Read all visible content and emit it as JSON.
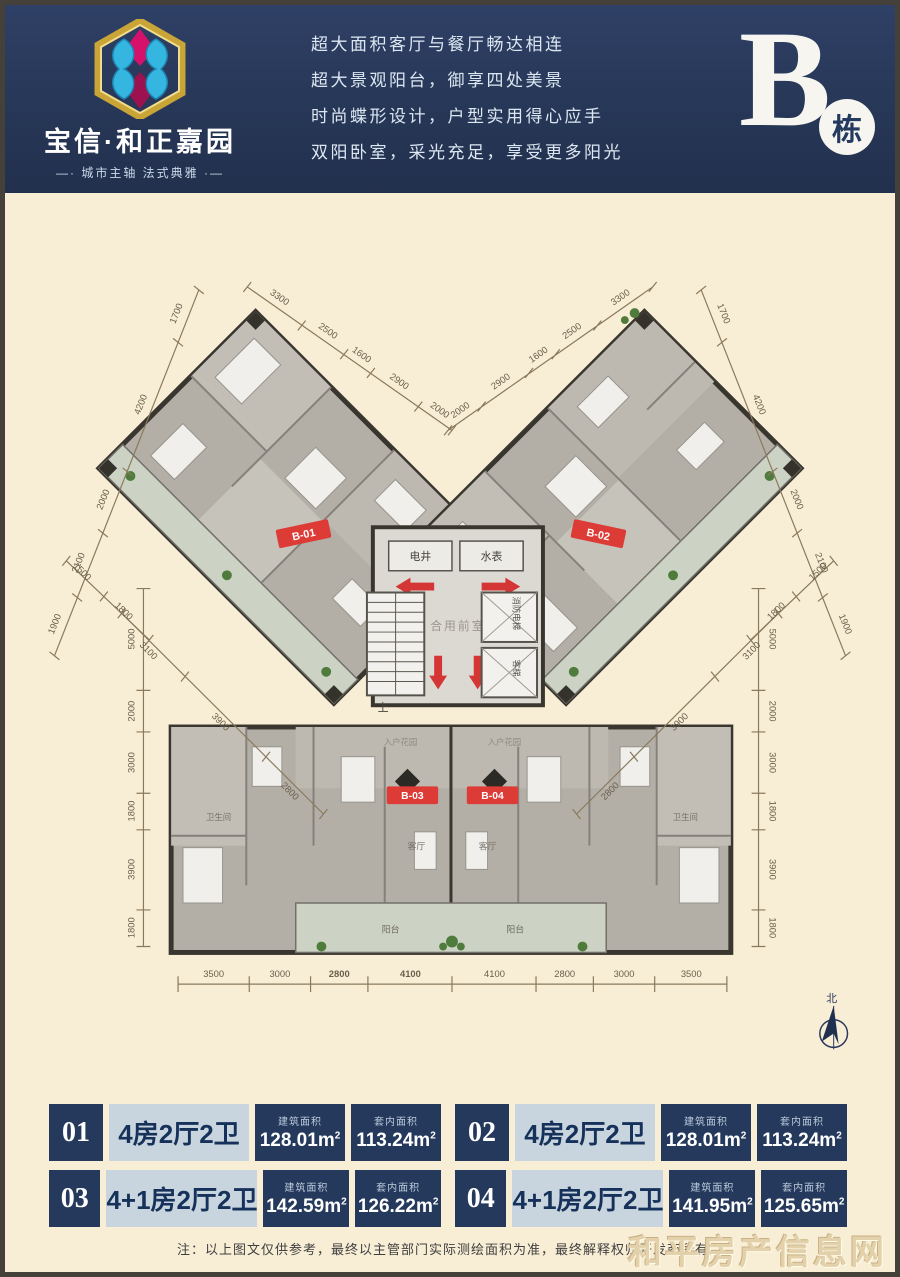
{
  "colors": {
    "header_navy": "#273757",
    "cream_bg": "#f8edd5",
    "accent_red": "#d84040",
    "table_navy": "#24395c",
    "table_light": "#c9d5de",
    "plan_wall": "#39362f",
    "balcony_green": "#ccd3c4"
  },
  "header": {
    "brand": {
      "name": "宝信·和正嘉园",
      "tagline": "—· 城市主轴 法式典雅 ·—"
    },
    "slogans": [
      "超大面积客厅与餐厅畅达相连",
      "超大景观阳台，御享四处美景",
      "时尚蝶形设计，户型实用得心应手",
      "双阳卧室，采光充足，享受更多阳光"
    ],
    "building": {
      "letter": "B",
      "suffix": "栋"
    }
  },
  "plan": {
    "units_labels": {
      "b01": "B-01",
      "b02": "B-02",
      "b03": "B-03",
      "b04": "B-04"
    },
    "core": {
      "electric": "电井",
      "water": "水表",
      "lobby": "合用前室",
      "stairs_up": "上",
      "fire_elevator": "消防电梯",
      "elevator": "客梯",
      "entry_garden": "入户花园"
    },
    "rooms": {
      "living": "客厅",
      "balcony": "阳台",
      "bath": "卫生间"
    },
    "compass_north": "北",
    "dims": {
      "bottom": [
        "3500",
        "3000",
        "2800",
        "4100",
        "4100",
        "2800",
        "3000",
        "3500"
      ],
      "left_v": [
        "5000",
        "2000",
        "3000",
        "1800",
        "3900",
        "1800"
      ],
      "right_v": [
        "5000",
        "2000",
        "3000",
        "1800",
        "3900",
        "1800"
      ],
      "top_left": [
        "3300",
        "2500",
        "1600",
        "2900",
        "2000"
      ],
      "top_right": [
        "2000",
        "2900",
        "1600",
        "2500",
        "3300"
      ],
      "outer_left": [
        "1700",
        "4200",
        "2000",
        "2100",
        "1900"
      ],
      "outer_right": [
        "1700",
        "4200",
        "2000",
        "2100",
        "1900"
      ],
      "lower_left": [
        "1500",
        "1800"
      ],
      "lower_right": [
        "1500",
        "1800"
      ],
      "inner_left": [
        "3100",
        "3900",
        "2800"
      ],
      "inner_right": [
        "3100",
        "3900",
        "2800"
      ]
    }
  },
  "area_labels": {
    "built": "建筑面积",
    "inner": "套内面积"
  },
  "area_unit": {
    "base": "m",
    "exp": "2"
  },
  "units": [
    {
      "no": "01",
      "type": "4房2厅2卫",
      "built": "128.01",
      "inner": "113.24"
    },
    {
      "no": "03",
      "type": "4+1房2厅2卫",
      "built": "142.59",
      "inner": "126.22"
    },
    {
      "no": "02",
      "type": "4房2厅2卫",
      "built": "128.01",
      "inner": "113.24"
    },
    {
      "no": "04",
      "type": "4+1房2厅2卫",
      "built": "141.95",
      "inner": "125.65"
    }
  ],
  "footer": {
    "note": "注：以上图文仅供参考，最终以主管部门实际测绘面积为准，最终解释权归开发商所有。",
    "watermark": "和平房产信息网"
  }
}
